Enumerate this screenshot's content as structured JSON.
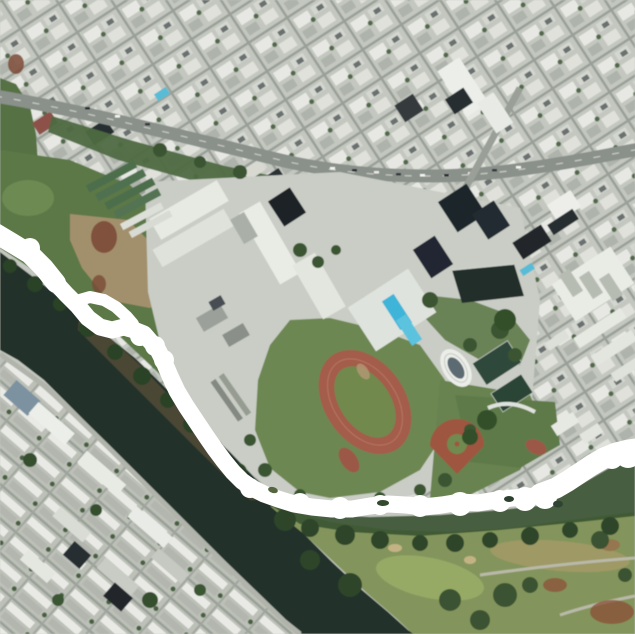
{
  "image": {
    "width": 635,
    "height": 634
  },
  "scene": {
    "type": "satellite-aerial-map",
    "description": "Aerial satellite view of a city district along a dark canal: dense diagonal street grid and buildings at top, a school campus with swimming pools, running track, ball diamond and small oval stadium in the center, apartment blocks across the canal at lower left, a golf course at lower right. A thick white freehand line is drawn over the map: it enters at the left edge, makes a small loop, follows the canal bank downward, sweeps east along the campus boundary and exits at the right edge.",
    "palette": {
      "annotation_white": "#ffffff",
      "water_dark": "#223329",
      "urban_base": "#c3c7bf",
      "building_white": "#e8e9e4",
      "roof_dark": "#20262b",
      "road_gray": "#8a908a",
      "park_green": "#5c7847",
      "dirt_tan": "#a2906c",
      "dirt_red_brown": "#7c4a37",
      "campus_lawn": "#6d8752",
      "track_red": "#a45c4c",
      "track_infield": "#71894e",
      "pool_cyan": "#3db4d8",
      "golf_green": "#83955c",
      "tree_dark_green": "#2e4529"
    },
    "annotation": {
      "color": "#ffffff",
      "main_width": 17,
      "branch_width": 12,
      "main_path": "M -8 230 L 12 242 L 28 252 L 42 266 L 55 282 L 66 294 L 78 306 L 88 318 L 100 327 L 112 330 L 124 327 L 134 330 L 144 334 L 150 341 L 158 350 L 164 362 L 170 376 L 177 391 L 186 406 L 196 421 L 206 436 L 215 449 L 224 461 L 233 472 L 242 481 L 252 488 L 264 494 L 278 499 L 294 504 L 312 507 L 332 509 L 352 509 L 370 506 L 388 504 L 406 505 L 424 507 L 442 505 L 460 502 L 478 503 L 496 500 L 512 498 L 528 497 L 542 494 L 556 488 L 568 481 L 580 472 L 592 464 L 604 457 L 616 452 L 628 449 L 644 447",
      "loop_branch_path": "M 76 301 L 90 297 L 104 300 L 116 307 L 127 317 L 133 324",
      "entry_head_path": "M -8 231 L 12 243 L 30 254 L 44 268 L 56 283",
      "exit_tail_path": "M 540 494 L 556 488 L 568 481 L 580 473 L 592 465 L 604 458 L 616 453 L 628 450 L 644 448"
    },
    "geometry": {
      "road_path": "M -5 96 C 90 112 180 136 280 160 C 340 174 420 181 500 172 C 560 165 600 156 640 149",
      "canal_points": "0,252 45,286 90,322 135,358 170,392 200,424 230,452 255,478 278,502 302,532 332,562 362,590 388,612 408,630 414,634 300,634 284,618 254,590 224,560 194,530 164,500 134,470 104,440 74,410 44,380 18,360 0,350",
      "golf_points": "270,506 330,522 390,530 450,532 510,528 570,520 635,512 635,634 413,634 396,618 368,594 336,564 304,534 284,518"
    },
    "features": [
      "city street grid and blocks",
      "main boulevard with traffic",
      "park and dirt field",
      "school campus buildings",
      "swimming pools",
      "running track",
      "baseball diamond",
      "oval stadium",
      "tennis courts",
      "canal",
      "canal-side road",
      "apartment blocks",
      "golf course",
      "tree cover",
      "white freehand annotation line"
    ]
  }
}
